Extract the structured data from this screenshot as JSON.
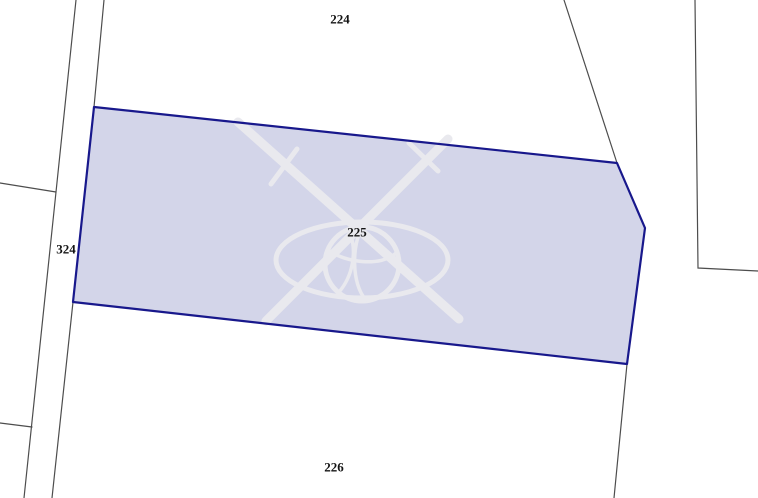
{
  "app": {
    "title": "Cadastral map view",
    "mode": "parcel-selection"
  },
  "map": {
    "colors": {
      "background": "#ffffff",
      "parcel_fill": "#d3d5e9",
      "parcel_stroke": "#18188c",
      "boundary": "#4d4d4d",
      "watermark": "#e9e9ee",
      "label": "#141414"
    },
    "selected_parcel": {
      "id": "225",
      "points": "94,107 617,163 645,228 627,364 73,302"
    },
    "boundaries": [
      {
        "id": "road-west-line",
        "points": "76,0 56,192 24,498"
      },
      {
        "id": "road-east-line-north",
        "points": "104,0 94,107"
      },
      {
        "id": "road-east-line-south",
        "points": "73,302 52,498"
      },
      {
        "id": "west-branch-upper",
        "points": "0,183 56,192"
      },
      {
        "id": "west-branch-lower",
        "points": "0,423 32,427"
      },
      {
        "id": "northeast-diagonal",
        "points": "564,0 617,163"
      },
      {
        "id": "southeast-line",
        "points": "627,364 614,498"
      },
      {
        "id": "east-corner-line",
        "points": "695,0 698,268 758,271"
      }
    ],
    "labels": [
      {
        "parcel": "224",
        "text": "224",
        "x": 340,
        "y": 19
      },
      {
        "parcel": "324",
        "text": "324",
        "x": 66,
        "y": 249
      },
      {
        "parcel": "225",
        "text": "225",
        "x": 357,
        "y": 232
      },
      {
        "parcel": "226",
        "text": "226",
        "x": 334,
        "y": 467
      }
    ]
  }
}
